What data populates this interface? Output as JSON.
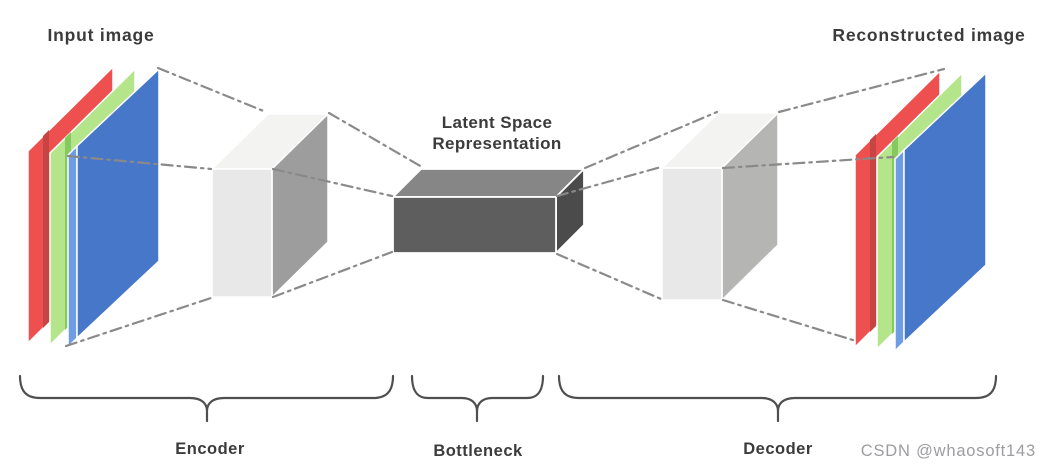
{
  "labels": {
    "input_image": "Input image",
    "reconstructed_image": "Reconstructed image",
    "latent_space_line1": "Latent Space",
    "latent_space_line2": "Representation",
    "encoder": "Encoder",
    "bottleneck": "Bottleneck",
    "decoder": "Decoder"
  },
  "watermark": "CSDN @whaosoft143",
  "diagram": {
    "type": "autoencoder-architecture",
    "blocks": [
      {
        "name": "input-image",
        "kind": "rgb-image-stack",
        "label": "Input image",
        "channels": [
          "red",
          "green",
          "blue"
        ]
      },
      {
        "name": "encoder",
        "kind": "3d-box-light",
        "label": "Encoder"
      },
      {
        "name": "bottleneck",
        "kind": "3d-box-dark",
        "label": "Bottleneck",
        "title": "Latent Space Representation"
      },
      {
        "name": "decoder",
        "kind": "3d-box-light",
        "label": "Decoder"
      },
      {
        "name": "reconstructed-image",
        "kind": "rgb-image-stack",
        "label": "Reconstructed image",
        "channels": [
          "red",
          "green",
          "blue"
        ]
      }
    ],
    "connections": "dash-dot guide lines from image-stack corners to encoder, encoder to bottleneck, bottleneck to decoder, decoder to reconstructed image"
  },
  "colors": {
    "red_face": "#ee4f4f",
    "red_bevel": "#f4928f",
    "red_dark": "#c64444",
    "green_face": "#b4e58a",
    "green_bevel": "#d6f2b3",
    "green_dark": "#86c95e",
    "blue_face": "#4677c9",
    "blue_strip": "#6f9de5",
    "blue_bevel": "#8db3ec",
    "box_front": "#e8e8e8",
    "box_top": "#f3f3f2",
    "encoder_side": "#9d9d9d",
    "decoder_side": "#b5b5b4",
    "bottleneck_front": "#5e5e5e",
    "bottleneck_top": "#868686",
    "bottleneck_side": "#4b4b4b",
    "dash": "#8a8a8a",
    "brace": "#4f4f4f",
    "label": "#3b3b3b",
    "watermark": "#9d9da1"
  }
}
